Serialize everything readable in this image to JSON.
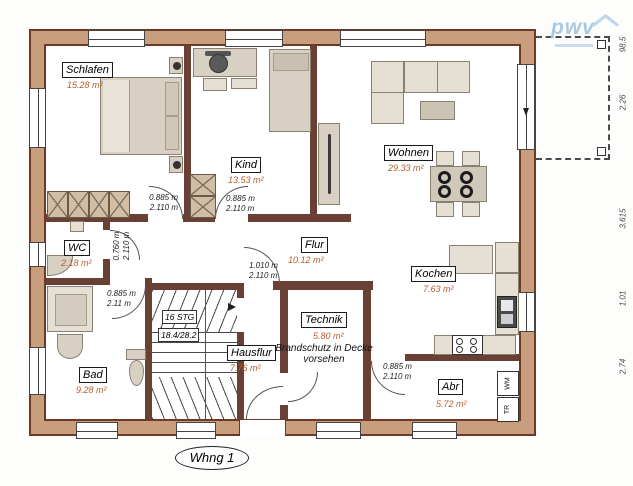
{
  "title": {
    "plan_label": "Whng 1",
    "logo_text": "pwv"
  },
  "rooms": {
    "schlafen": {
      "name": "Schlafen",
      "area": "15.28 m²"
    },
    "kind": {
      "name": "Kind",
      "area": "13.53 m²"
    },
    "wohnen": {
      "name": "Wohnen",
      "area": "29.33 m²"
    },
    "wc": {
      "name": "WC",
      "area": "2.18 m²"
    },
    "flur": {
      "name": "Flur",
      "area": "10.12 m²"
    },
    "kochen": {
      "name": "Kochen",
      "area": "7.63 m²"
    },
    "bad": {
      "name": "Bad",
      "area": "9.28 m²"
    },
    "hausflur": {
      "name": "Hausflur",
      "area": "7.76 m²"
    },
    "technik": {
      "name": "Technik",
      "area": "5.80 m²"
    },
    "abr": {
      "name": "Abr",
      "area": "5.72 m²"
    }
  },
  "doors": {
    "schlafen": {
      "w": "0.885 m",
      "h": "2.110 m"
    },
    "kind": {
      "w": "0.885 m",
      "h": "2.110 m"
    },
    "wc": {
      "w": "0.760 m",
      "h": "2.110 m"
    },
    "bad": {
      "w": "0.885 m",
      "h": "2.11 m"
    },
    "hausflur": {
      "w": "1.010 m",
      "h": "2.110 m"
    },
    "abr": {
      "w": "0.885 m",
      "h": "2.110 m"
    }
  },
  "stairs": {
    "steps": "16 STG",
    "ratio": "18.4/28.2"
  },
  "note": {
    "line1": "Brandschutz in Decke",
    "line2": "vorsehen"
  },
  "appliances": {
    "washer": "WM",
    "dryer": "TR"
  },
  "dimensions_right": [
    "98.5",
    "2.26",
    "3.615",
    "1.01",
    "2.74"
  ],
  "colors": {
    "wall_fill": "#c99e7c",
    "wall_edge": "#6f3928",
    "area_text": "#b65c2e",
    "logo_blue": "#a9c9e2"
  }
}
